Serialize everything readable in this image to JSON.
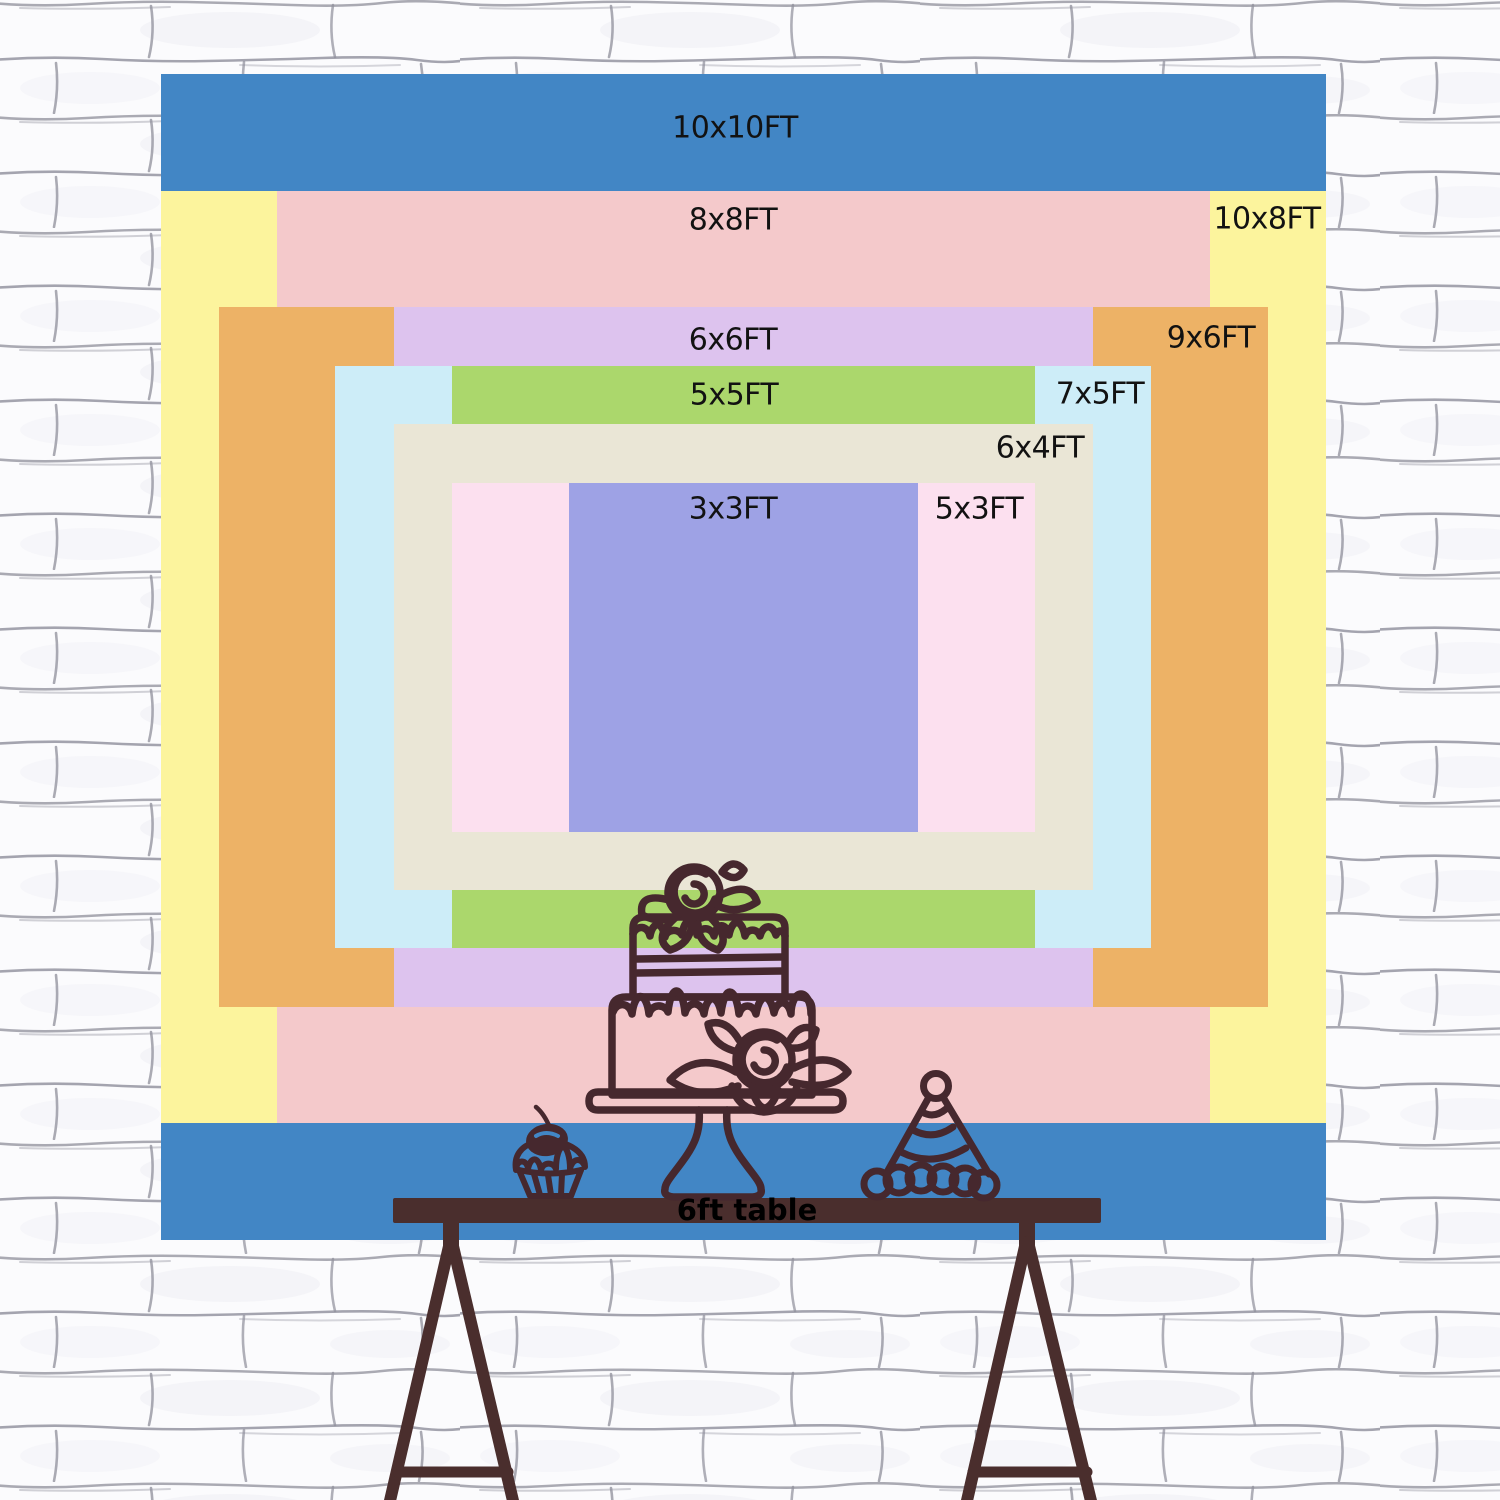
{
  "backdrop": {
    "label_color": "#121212",
    "sizes": [
      {
        "label": "10x10FT",
        "width_ft": 10,
        "height_ft": 10,
        "color": "#4286c5"
      },
      {
        "label": "10x8FT",
        "width_ft": 10,
        "height_ft": 8,
        "color": "#fcf49d"
      },
      {
        "label": "8x8FT",
        "width_ft": 8,
        "height_ft": 8,
        "color": "#f4c9cb"
      },
      {
        "label": "9x6FT",
        "width_ft": 9,
        "height_ft": 6,
        "color": "#edb266"
      },
      {
        "label": "6x6FT",
        "width_ft": 6,
        "height_ft": 6,
        "color": "#ddc3ee"
      },
      {
        "label": "7x5FT",
        "width_ft": 7,
        "height_ft": 5,
        "color": "#cdedf8"
      },
      {
        "label": "5x5FT",
        "width_ft": 5,
        "height_ft": 5,
        "color": "#abd76c"
      },
      {
        "label": "6x4FT",
        "width_ft": 6,
        "height_ft": 4,
        "color": "#eae6d6"
      },
      {
        "label": "5x3FT",
        "width_ft": 5,
        "height_ft": 3,
        "color": "#fce0ef"
      },
      {
        "label": "3x3FT",
        "width_ft": 3,
        "height_ft": 3,
        "color": "#9ea2e5"
      }
    ]
  },
  "table": {
    "label": "6ft table",
    "label_color": "#000000",
    "wood_color": "#4a2e2d"
  },
  "illustrations": {
    "line_color": "#46282e",
    "items": [
      "two-tier-cake-on-stand",
      "cupcake-with-cherry",
      "party-hat"
    ]
  },
  "wall": {
    "base_color": "#fbfbfd",
    "mortar_color": "#8f8f9b"
  }
}
